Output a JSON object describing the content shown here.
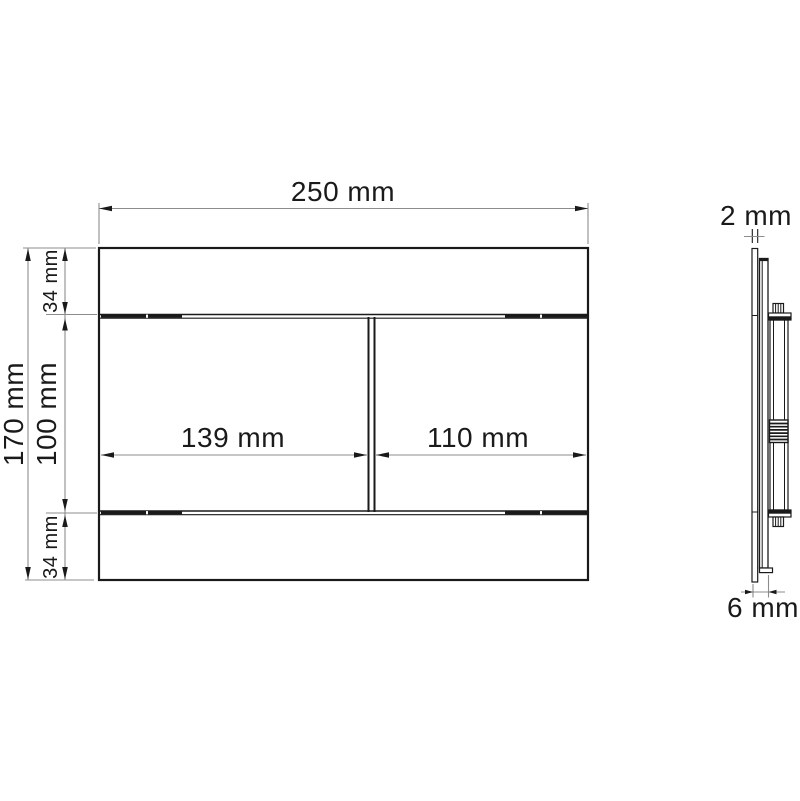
{
  "drawing": {
    "title": "flush-plate-dimension-drawing",
    "front_view": {
      "width_label": "250 mm",
      "height_label": "170 mm",
      "top_strip_label": "34 mm",
      "middle_height_label": "100 mm",
      "bottom_strip_label": "34 mm",
      "left_button_label": "139 mm",
      "right_button_label": "110 mm"
    },
    "side_view": {
      "plate_thickness_label": "2 mm",
      "depth_label": "6 mm"
    },
    "colors": {
      "background": "#ffffff",
      "outline": "#1a1a1a",
      "dimension_line": "#8c8c8c",
      "text": "#1a1a1a"
    }
  }
}
